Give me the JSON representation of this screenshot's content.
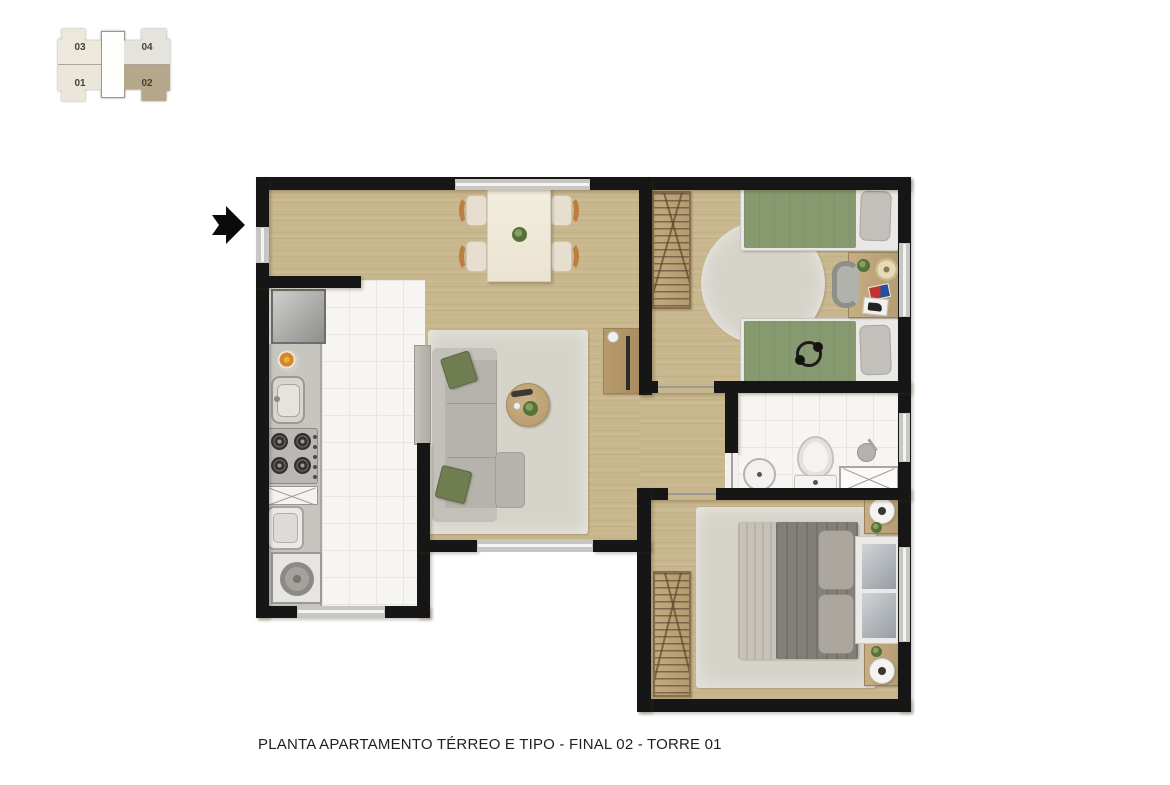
{
  "caption": "PLANTA APARTAMENTO TÉRREO E TIPO - FINAL 02 - TORRE 01",
  "key_plan": {
    "units": [
      {
        "label": "03"
      },
      {
        "label": "01"
      },
      {
        "label": "04"
      },
      {
        "label": "02"
      }
    ],
    "highlighted_unit": "02"
  },
  "colors": {
    "wall": "#161616",
    "wood": "#c8b68c",
    "tile": "#f6f5f2",
    "rug": "#d6d3ca",
    "counter": "#c6c5c0",
    "sofa": "#b5b3ab",
    "pillow": "#6f7d51",
    "bed-green": "#87996f",
    "furniture-wood": "#bfa77c",
    "unit-cream": "#ece8dc",
    "unit-gray": "#e5e3dd",
    "unit-highlight": "#b4a78a"
  }
}
